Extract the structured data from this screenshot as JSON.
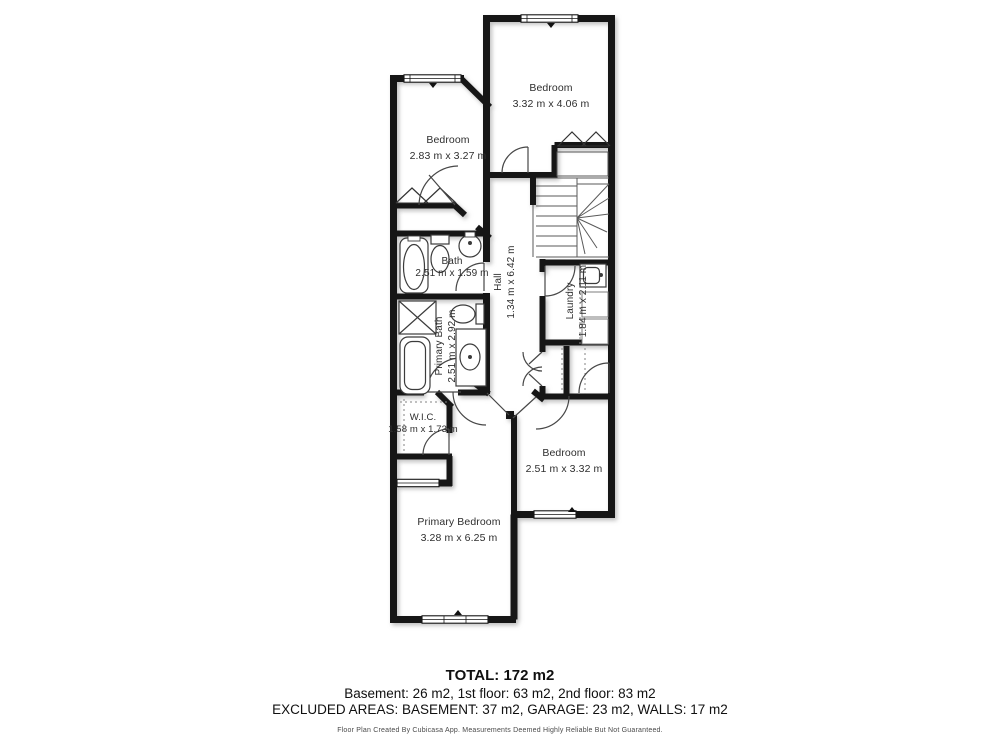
{
  "plan": {
    "rooms": [
      {
        "name": "Bedroom",
        "dims": "3.32 m x 4.06 m"
      },
      {
        "name": "Bedroom",
        "dims": "2.83 m x 3.27 m"
      },
      {
        "name": "Bath",
        "dims": "2.51 m x 1.59 m"
      },
      {
        "name": "Hall",
        "dims": "1.34 m x 6.42 m"
      },
      {
        "name": "Laundry",
        "dims": "1.84 m x 2.11 m"
      },
      {
        "name": "Primary Bath",
        "dims": "2.51 m x 2.92 m"
      },
      {
        "name": "W.I.C.",
        "dims": "1.58 m x 1.73 m"
      },
      {
        "name": "Bedroom",
        "dims": "2.51 m x 3.32 m"
      },
      {
        "name": "Primary Bedroom",
        "dims": "3.28 m x 6.25 m"
      }
    ],
    "colors": {
      "wall": "#161616",
      "fixture": "#3c3c3c",
      "shadow": "#8a8a8a"
    }
  },
  "summary": {
    "total": "TOTAL: 172 m2",
    "floors": "Basement: 26 m2, 1st floor: 63 m2, 2nd floor: 83 m2",
    "excluded": "EXCLUDED AREAS: BASEMENT: 37 m2, GARAGE: 23 m2, WALLS: 17 m2"
  },
  "footer": {
    "disclaimer": "Floor Plan Created By Cubicasa App. Measurements Deemed Highly Reliable But Not Guaranteed."
  }
}
